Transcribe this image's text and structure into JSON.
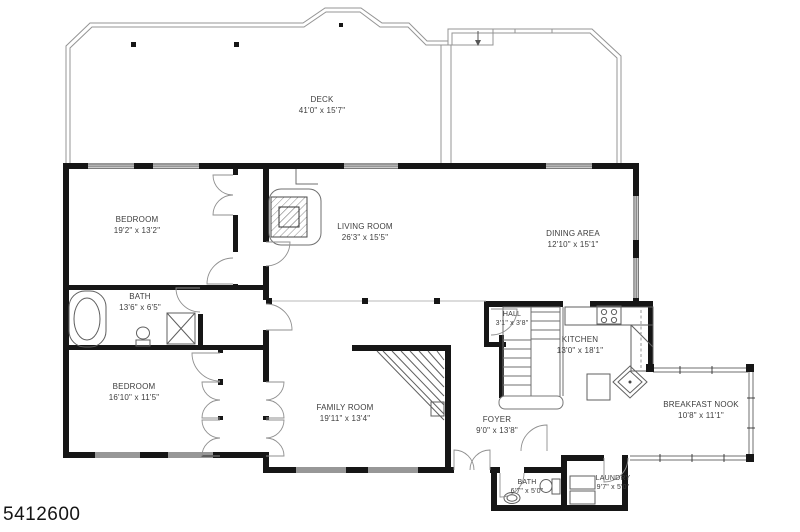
{
  "page": {
    "background": "#ffffff"
  },
  "colors": {
    "wall": "#161616",
    "thin_line": "#6f6f6f",
    "label_text": "#3d3d3d"
  },
  "watermark": {
    "id": "5412600"
  },
  "rooms": [
    {
      "id": "deck",
      "name": "DECK",
      "dims": "41'0\" x 15'7\""
    },
    {
      "id": "bedroom-1",
      "name": "BEDROOM",
      "dims": "19'2\" x 13'2\""
    },
    {
      "id": "living-room",
      "name": "LIVING ROOM",
      "dims": "26'3\" x 15'5\""
    },
    {
      "id": "dining-area",
      "name": "DINING AREA",
      "dims": "12'10\" x 15'1\""
    },
    {
      "id": "bath-1",
      "name": "BATH",
      "dims": "13'6\" x 6'5\""
    },
    {
      "id": "bedroom-2",
      "name": "BEDROOM",
      "dims": "16'10\" x 11'5\""
    },
    {
      "id": "family-room",
      "name": "FAMILY ROOM",
      "dims": "19'11\" x 13'4\""
    },
    {
      "id": "hall",
      "name": "HALL",
      "dims": "3'1\" x 3'8\""
    },
    {
      "id": "kitchen",
      "name": "KITCHEN",
      "dims": "13'0\" x 18'1\""
    },
    {
      "id": "foyer",
      "name": "FOYER",
      "dims": "9'0\" x 13'8\""
    },
    {
      "id": "breakfast-nook",
      "name": "BREAKFAST NOOK",
      "dims": "10'8\" x 11'1\""
    },
    {
      "id": "bath-2",
      "name": "BATH",
      "dims": "6'7\" x 5'0\""
    },
    {
      "id": "laundry",
      "name": "LAUNDRY",
      "dims": "9'7\" x 5'0\""
    }
  ]
}
